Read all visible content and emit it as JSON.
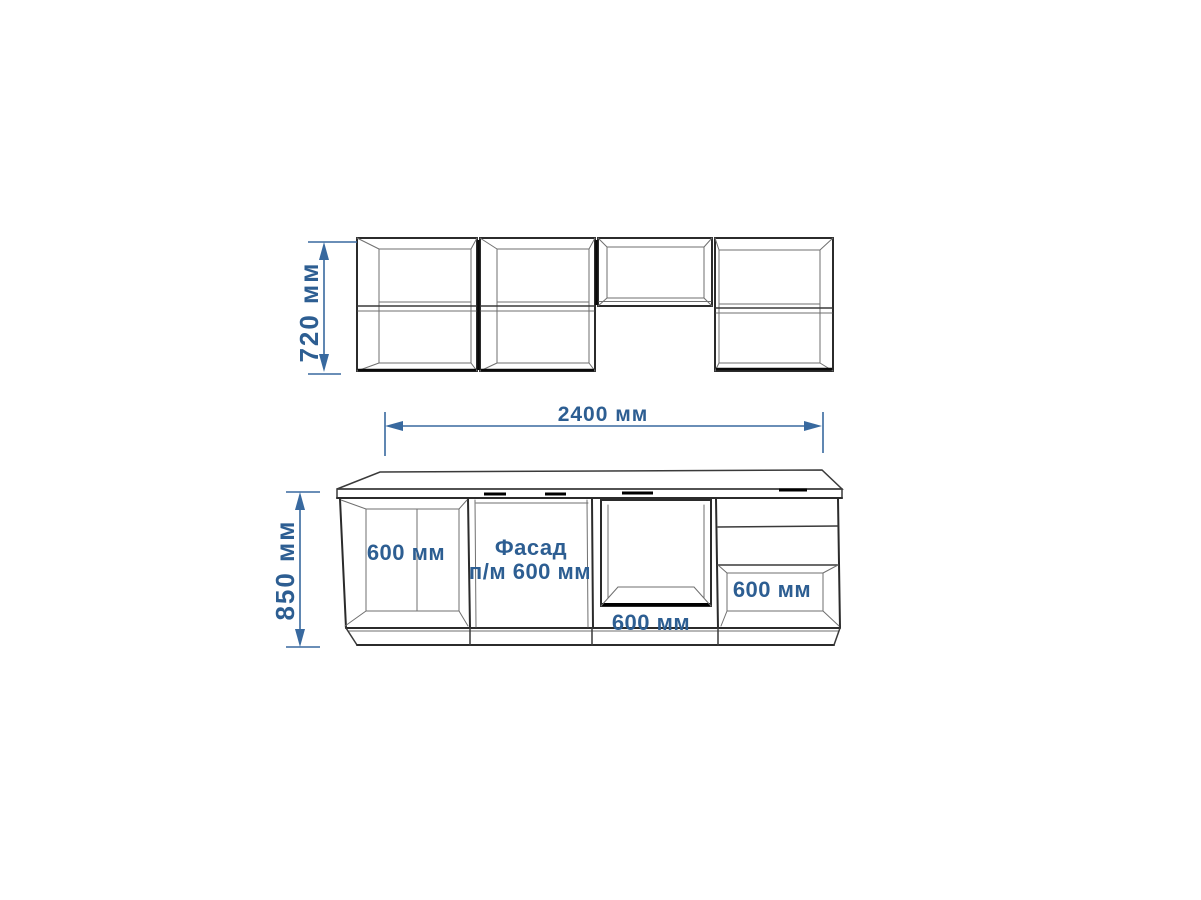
{
  "drawing": {
    "type": "kitchen-furniture-dimension-drawing",
    "upper_run": {
      "height_dimension_label": "720 мм"
    },
    "total_width_dimension_label": "2400 мм",
    "base_run": {
      "height_dimension_label": "850 мм",
      "cabinet_1_label": "600 мм",
      "cabinet_2_label_line1": "Фасад",
      "cabinet_2_label_line2": "п/м 600 мм",
      "cabinet_3_label": "600 мм",
      "cabinet_4_label": "600 мм"
    },
    "colors": {
      "dimension_text": "#2d5e92",
      "dimension_line": "#38699f",
      "outline": "#2b2b2b"
    }
  }
}
